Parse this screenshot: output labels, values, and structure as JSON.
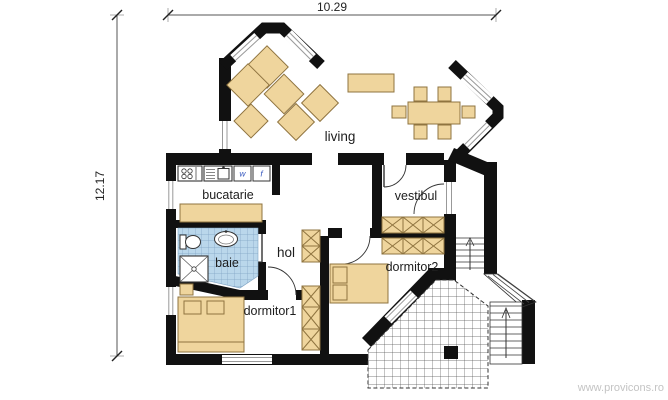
{
  "plan": {
    "title": "house floor plan",
    "dimensions": {
      "width_label": "10.29",
      "height_label": "12.17"
    },
    "rooms": {
      "living": "living",
      "bucatarie": "bucatarie",
      "vestibul": "vestibul",
      "hol": "hol",
      "baie": "baie",
      "dormitor1": "dormitor1",
      "dormitor2": "dormitor2"
    },
    "kitchen": {
      "washer_label": "w",
      "fridge_label": "f"
    },
    "watermark": "www.provicons.ro",
    "colors": {
      "wall": "#111111",
      "furniture": "#efd59d",
      "furniture_border": "#8f7440",
      "bath_tile": "#bad7eb",
      "bath_tile_grid": "#7fa3c4",
      "window_glass_line": "#999999",
      "dimension_line": "#555555",
      "watermark_text": "#c4c4c4"
    }
  }
}
